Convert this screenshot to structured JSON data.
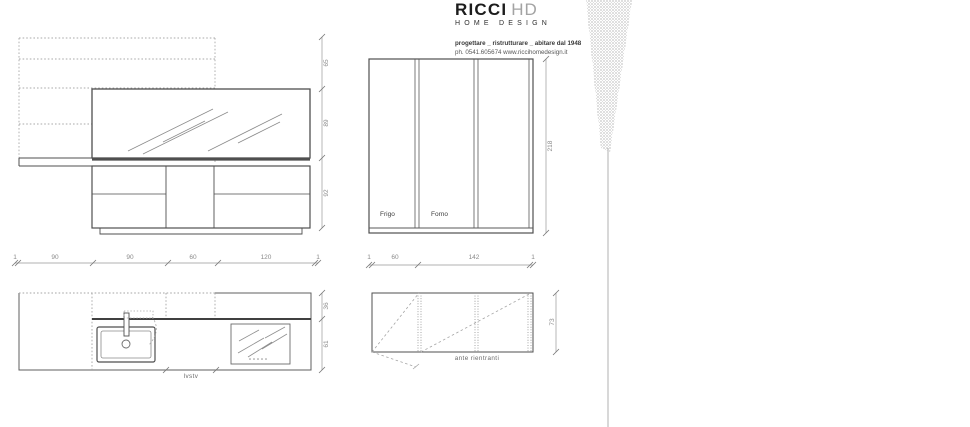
{
  "brand": {
    "name_primary": "RICCI",
    "name_secondary": "HD",
    "subtitle": "HOME DESIGN",
    "tagline": "progettare _ ristrutturare _ abitare dal 1948",
    "contact": "ph. 0541.605674   www.riccihomedesign.it"
  },
  "elevation_main": {
    "height_dims": [
      "65",
      "89",
      "92"
    ],
    "width_dims": [
      "1",
      "90",
      "90",
      "60",
      "120",
      "1"
    ]
  },
  "tall_units": {
    "fridge_label": "Frigo",
    "oven_label": "Forno",
    "height_dim": "218",
    "width_dims": [
      "1",
      "60",
      "142",
      "1"
    ]
  },
  "plan": {
    "depth_dims": [
      "36",
      "61"
    ],
    "dishwasher_label": "lvstv"
  },
  "wall_units": {
    "height_dim": "73",
    "caption": "ante rientranti"
  },
  "colors": {
    "line": "#555555",
    "dashed": "#a5a5a5",
    "dim": "#8a8a8a",
    "sketch": "#9a9a9a"
  }
}
